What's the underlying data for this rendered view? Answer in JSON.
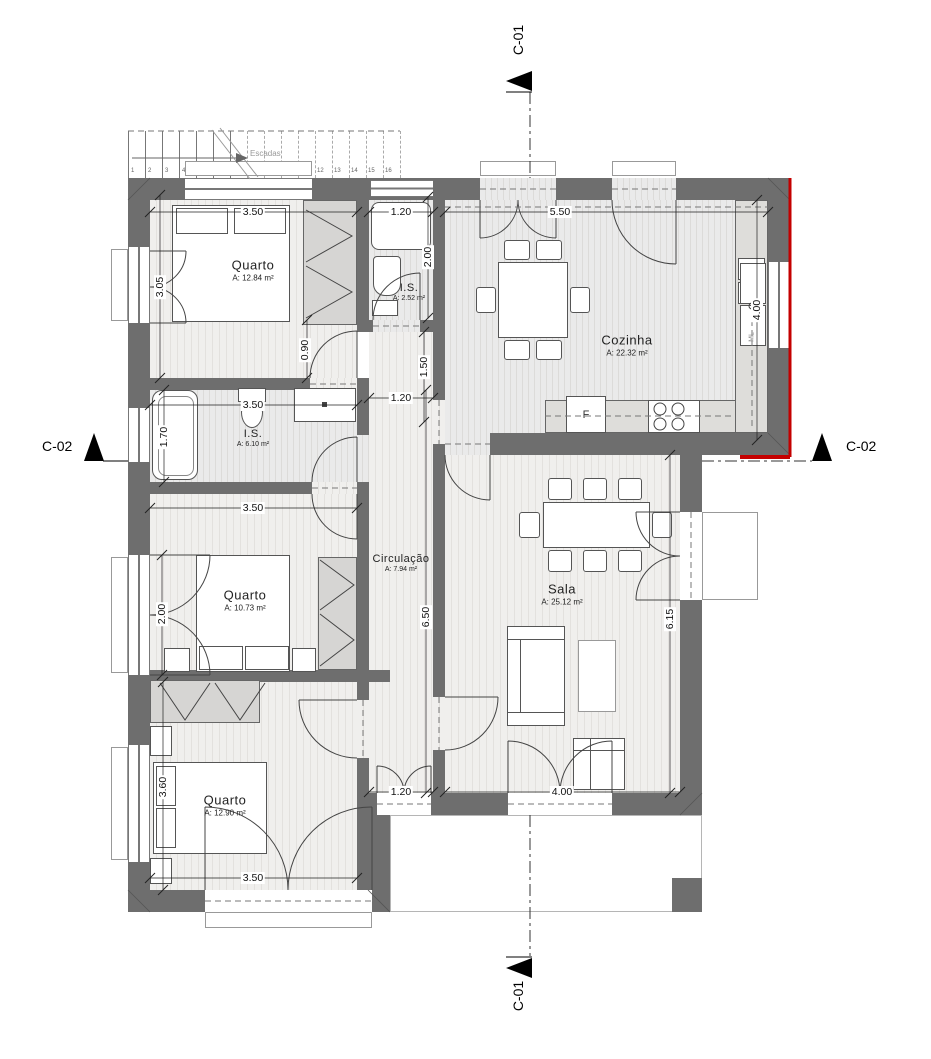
{
  "markers": {
    "c01_top": "C-01",
    "c01_bottom": "C-01",
    "c02_left": "C-02",
    "c02_right": "C-02"
  },
  "stairs": {
    "label": "Escadas",
    "steps": [
      "1",
      "2",
      "3",
      "4",
      "5",
      "6",
      "7",
      "8",
      "9",
      "10",
      "11",
      "12",
      "13",
      "14",
      "15",
      "16"
    ]
  },
  "rooms": {
    "quarto1": {
      "name": "Quarto",
      "area": "A: 12.84 m²"
    },
    "is1": {
      "name": "I.S.",
      "area": "A: 2.52 m²"
    },
    "cozinha": {
      "name": "Cozinha",
      "area": "A: 22.32 m²"
    },
    "is2": {
      "name": "I.S.",
      "area": "A: 6.10 m²"
    },
    "quarto2": {
      "name": "Quarto",
      "area": "A: 10.73 m²"
    },
    "circulacao": {
      "name": "Circulação",
      "area": "A: 7.94 m²"
    },
    "sala": {
      "name": "Sala",
      "area": "A: 25.12 m²"
    },
    "quarto3": {
      "name": "Quarto",
      "area": "A: 12.90 m²"
    }
  },
  "appliances": {
    "fridge": "F",
    "washer": "ML"
  },
  "dims": {
    "q1_width": "3.50",
    "is1_width": "1.20",
    "cozinha_width": "5.50",
    "q1_height": "3.05",
    "is1_height": "2.00",
    "cozinha_height": "4.00",
    "q1_door": "0.90",
    "hall_top": "1.50",
    "hall_width": "1.20",
    "is2_width": "3.50",
    "is2_height": "1.70",
    "q2_width": "3.50",
    "q2_window": "2.00",
    "circ_height": "6.50",
    "sala_height": "6.15",
    "q3_height": "3.60",
    "circ_exit": "1.20",
    "sala_width": "4.00",
    "q3_width": "3.50"
  },
  "colors": {
    "wall": "#6e6e6e",
    "red_mark": "#c40000"
  }
}
